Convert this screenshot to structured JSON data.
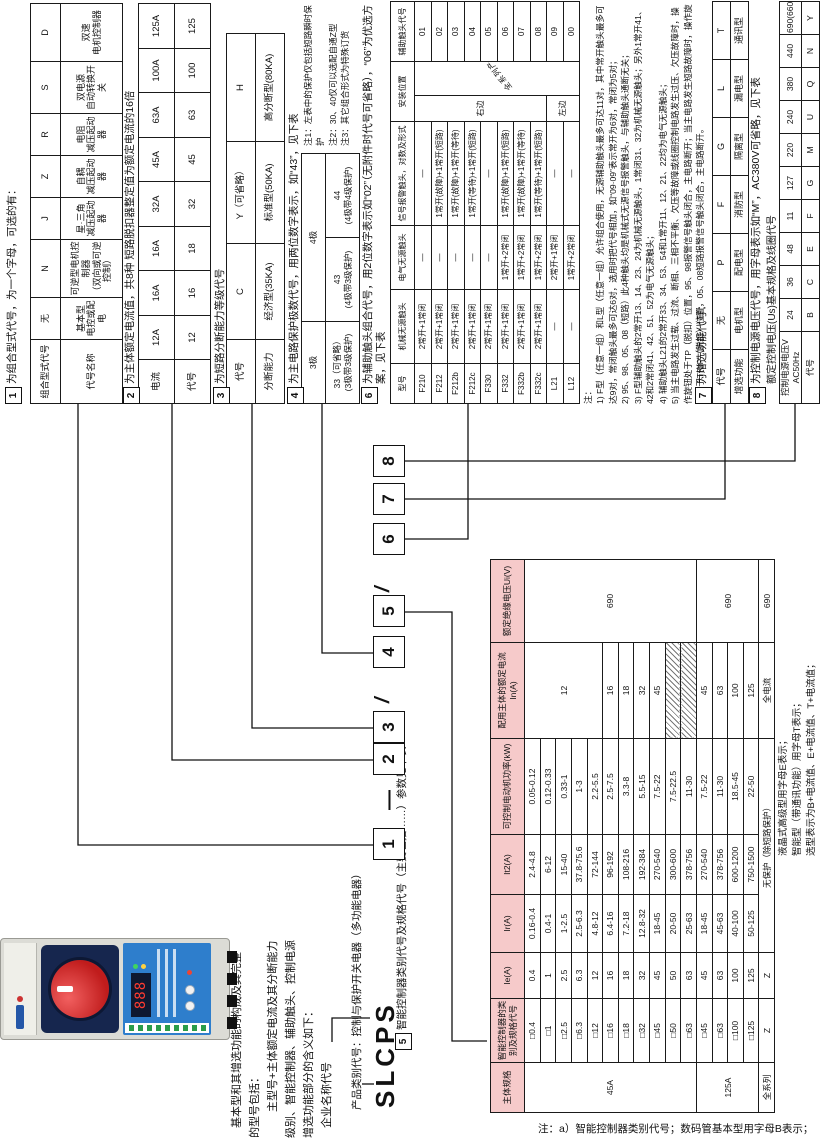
{
  "footer_note": "注：a）智能控制器类别代号；数码管基本型用字母B表示；",
  "brand": "SLCPS",
  "photo": {
    "display": "888"
  },
  "description": {
    "lines": [
      "基本型和其增选功能的构成及其完整",
      "的型号包括：",
      "主型号+主体额定电流及其分断能力",
      "级别、智能控制器、辅助触头、控制电源",
      "增选功能部分的含义如下：",
      "企业名称代号"
    ]
  },
  "model_line": {
    "digits": [
      "1",
      "2",
      "3",
      "4",
      "5",
      "6",
      "7",
      "8"
    ],
    "dash": "—",
    "slash": "/"
  },
  "titles": [
    {
      "n": "1",
      "t": "为组合型式代号，为一个字母，可选的有：",
      "x": 742,
      "y": 6,
      "w": 400
    },
    {
      "n": "2",
      "t": "为主体额定电流值，共8种 短路脱扣器整定值为额定电流的16倍",
      "x": 742,
      "y": 124,
      "w": 400
    },
    {
      "n": "3",
      "t": "为短路分断能力等级代号",
      "x": 742,
      "y": 214,
      "w": 400
    },
    {
      "n": "4",
      "t": "为主电路保护极数代号，用两位数字表示，如“43”，见下表",
      "x": 742,
      "y": 288,
      "w": 400
    },
    {
      "n": "6",
      "t": "为辅助触头组合代号，用2位数字表示如“02”（无附件时代号可省略），“06”为优选方案，见下表",
      "x": 742,
      "y": 362,
      "w": 382
    },
    {
      "n": "7",
      "t": "为增选功能代号：",
      "x": 742,
      "y": 696,
      "w": 380
    },
    {
      "n": "8",
      "t": "为控制电源电压代号，用字母表示如“M”，AC380V可省略，见下表",
      "x": 742,
      "y": 750,
      "w": 382
    },
    {
      "n": "5",
      "t": "智能控制器类别代号及规格代号（主要包括……）参数见下表",
      "x": 96,
      "y": 396,
      "w": 420
    }
  ],
  "texts": [
    {
      "name": "product-category-label",
      "t": "产品类别代号：控制与保护开关电器（多功能电器）",
      "x": 36,
      "y": 350,
      "w": 300,
      "s": 10.5,
      "nowrap": true
    },
    {
      "name": "voltage-subtitle",
      "t": "额定控制电压(Us)基本规格及线圈代号",
      "x": 762,
      "y": 766,
      "w": 360,
      "s": 10
    },
    {
      "name": "pole-table-notes",
      "t": "注1：左表中的保护仅包括短路瞬时保护\n注2：30、40仅可以选配自通Z型\n注3：其它组合形式为特殊订货",
      "x": 1000,
      "y": 302,
      "w": 146,
      "s": 8.5
    },
    {
      "name": "aux-contact-notes",
      "t": "注：\n1) F型（任意一组）和L型（任意一组）允许组合使用，无源辅助触头最多可达11对，其中常开触头最多可达9对，常闭触头最多可达6对，选用时把代号相加，如“09·09”表示常开为6对，常闭为5对；\n2) 95、98、05、08（短路）此4种触头均是机械式无源信号报警触头，与辅助触头通断无关；\n3) F型辅助触头的2常开13、14、23、24为机械无源触头，1常闭31、32为机械无源触头；另外1常开41、42和2常闭41、42、51、52为电气无源触头；\n4) 辅助触头L21的2常开33、34、53、54和1常开11、12、21、22均为电气无源触头；\n5) 当主电路发生过载、过流、断相、三相不平衡、欠压等故障或线圈控制电路发生过压、欠压故障时，操作旋钮处于TP（脱扣）位置，95、98报警信号触头闭合，主电路断开；当主电路发生短路故障时，操作旋钮处于TRIP（脱扣）位置，05、08短路报警信号触头闭合，主电路断开。",
      "x": 742,
      "y": 582,
      "w": 404,
      "s": 8.6
    },
    {
      "name": "controller-note-1",
      "t": "液晶式高级型用字母E表示；",
      "x": 290,
      "y": 777,
      "w": 320,
      "s": 9.5,
      "nowrap": true
    },
    {
      "name": "controller-note-2",
      "t": "智能型（带通讯功能）用字母T表示；",
      "x": 290,
      "y": 791,
      "w": 320,
      "s": 9.5,
      "nowrap": true
    },
    {
      "name": "controller-note-3",
      "t": "选型表示为B+电流值、E+电流值、T+电流值；",
      "x": 290,
      "y": 805,
      "w": 330,
      "s": 9.5,
      "nowrap": true
    }
  ],
  "tables": [
    {
      "name": "table-combination-type",
      "x": 742,
      "y": 30,
      "w": 400,
      "h": 92,
      "fs": 9,
      "cols": [
        64,
        42,
        58,
        42,
        42,
        42,
        52,
        58
      ],
      "rh": [
        30,
        62
      ],
      "rows": [
        [
          "组合型式代号",
          "无",
          "N",
          "J",
          "Z",
          "R",
          "S",
          "D"
        ],
        [
          "代号名称",
          "基本型\n电控或配电",
          "可逆型电机控制器\n（双向或可逆控制）",
          "星·三角\n减压起动器",
          "自耦\n减压起动器",
          "电阻\n减压起动器",
          "双电源\n自动转换开关",
          "双速\n电机控制器"
        ]
      ]
    },
    {
      "name": "table-rated-current",
      "x": 742,
      "y": 138,
      "w": 400,
      "h": 72,
      "fs": 9.5,
      "cols": [
        44,
        44,
        45,
        44,
        45,
        44,
        45,
        44,
        45
      ],
      "rh": [
        36,
        36
      ],
      "rows": [
        [
          "电流",
          "12A",
          "16A",
          "16A",
          "32A",
          "45A",
          "63A",
          "100A",
          "125A"
        ],
        [
          "代号",
          "12",
          "16",
          "18",
          "32",
          "45",
          "63",
          "100",
          "125"
        ]
      ]
    },
    {
      "name": "table-breaking-capacity",
      "x": 742,
      "y": 226,
      "w": 370,
      "h": 58,
      "fs": 9.5,
      "cols": [
        64,
        96,
        102,
        108
      ],
      "rh": [
        29,
        29
      ],
      "rows": [
        [
          "代号",
          "C",
          "Y（可省略）",
          "H"
        ],
        [
          "分断能力",
          "经济型(35KA)",
          "标准型(50KA)",
          "高分断型(80KA)"
        ]
      ]
    },
    {
      "name": "table-pole-count",
      "x": 742,
      "y": 301,
      "w": 250,
      "h": 58,
      "fs": 8.5,
      "cols": [
        82,
        84,
        84
      ],
      "rh": [
        24,
        34
      ],
      "rows": [
        [
          "3极",
          {
            "t": "4极",
            "cs": 2
          }
        ],
        [
          "33（可省略）\n(3极带3级保护)",
          "43\n(4极带3级保护)",
          "44\n(4极带4级保护)"
        ]
      ]
    },
    {
      "name": "table-aux-contacts",
      "x": 742,
      "y": 390,
      "w": 402,
      "h": 190,
      "fs": 8,
      "cols": [
        40,
        74,
        64,
        104,
        26,
        34,
        60
      ],
      "rh": [
        24
      ],
      "rows": [
        [
          "型号",
          "机械无源触头",
          "电气无源触头",
          "信号报警触头，对数及形式",
          {
            "t": "安装位置",
            "cs": 2
          },
          "辅助触头代号"
        ],
        [
          "F210",
          "2常开+1常闭",
          "—",
          "—",
          {
            "t": "右边",
            "rs": 8
          },
          {
            "t": "全系列产品",
            "rs": 10,
            "cls": "diag"
          },
          "01"
        ],
        [
          "F212",
          "2常开+1常闭",
          "—",
          "1常开(故障)+1常开(短路)",
          "02"
        ],
        [
          "F212b",
          "2常开+1常闭",
          "—",
          "1常开(故障)+1常开(等待)",
          "03"
        ],
        [
          "F212c",
          "2常开+1常闭",
          "—",
          "1常开(等待)+1常开(短路)",
          "04"
        ],
        [
          "F330",
          "2常开+1常闭",
          "—",
          "—",
          "05"
        ],
        [
          "F332",
          "2常开+1常闭",
          "1常开+2常闭",
          "1常开(故障)+1常开(短路)",
          "06"
        ],
        [
          "F332b",
          "2常开+1常闭",
          "1常开+2常闭",
          "1常开(故障)+1常开(等待)",
          "07"
        ],
        [
          "F332c",
          "2常开+1常闭",
          "1常开+2常闭",
          "1常开(等待)+1常开(短路)",
          "08"
        ],
        [
          "L21",
          "—",
          "2常开+1常闭",
          "—",
          {
            "t": "左边",
            "rs": 2
          },
          "09"
        ],
        [
          "L12",
          "—",
          "1常开+2常闭",
          "—",
          "00"
        ]
      ]
    },
    {
      "name": "table-optional-functions",
      "x": 742,
      "y": 712,
      "w": 402,
      "h": 36,
      "fs": 9,
      "cols": [
        54,
        58,
        58,
        58,
        58,
        58,
        58
      ],
      "rh": [
        18,
        18
      ],
      "rows": [
        [
          "代号",
          "无",
          "P",
          "F",
          "G",
          "L",
          "T"
        ],
        [
          "增选功能",
          "电机型",
          "配电型",
          "消防型",
          "隔离型",
          "漏电型",
          "通讯型"
        ]
      ]
    },
    {
      "name": "table-control-voltage",
      "x": 742,
      "y": 779,
      "w": 402,
      "h": 40,
      "fs": 8.5,
      "cols": [
        72,
        33,
        33,
        33,
        33,
        33,
        33,
        33,
        33,
        33,
        33
      ],
      "rh": [
        22,
        18
      ],
      "rows": [
        [
          {
            "t": "控制电源电压V\nAC50Hz",
            "cls": "grp"
          },
          "24",
          "36",
          "48",
          "11",
          "127",
          "220",
          "240",
          "380",
          "440",
          "690(660)"
        ],
        [
          "代号",
          "B",
          "C",
          "E",
          "F",
          "G",
          "M",
          "U",
          "Q",
          "N",
          "Y"
        ]
      ]
    },
    {
      "name": "table-controller-specs",
      "x": 33,
      "y": 490,
      "w": 553,
      "h": 285,
      "fs": 8.5,
      "cols": [
        50,
        64,
        46,
        58,
        60,
        96,
        96,
        83
      ],
      "rh": [
        34
      ],
      "rows": [
        [
          {
            "t": "主体规格",
            "cls": "pinkhdr"
          },
          {
            "t": "智能控制器的类别及规格代号",
            "cls": "pinkhdr"
          },
          {
            "t": "Ie(A)",
            "cls": "pinkhdr"
          },
          {
            "t": "Ir(A)",
            "cls": "pinkhdr"
          },
          {
            "t": "It2(A)",
            "cls": "pinkhdr"
          },
          {
            "t": "可控制电动机功率(kW)",
            "cls": "pinkhdr"
          },
          {
            "t": "配用主体的额定电流In(A)",
            "cls": "pinkhdr"
          },
          {
            "t": "额定绝缘电压Ui(V)",
            "cls": "pinkhdr"
          }
        ],
        [
          {
            "t": "45A",
            "rs": 11,
            "cls": "grp"
          },
          "□0.4",
          "0.4",
          "0.16-0.4",
          "2.4-4.8",
          "0.05-0.12",
          {
            "t": "12",
            "rs": 5
          },
          {
            "t": "690",
            "rs": 11
          }
        ],
        [
          "□1",
          "1",
          "0.4-1",
          "6-12",
          "0.12-0.33"
        ],
        [
          "□2.5",
          "2.5",
          "1-2.5",
          "15-40",
          "0.33-1"
        ],
        [
          "□6.3",
          "6.3",
          "2.5-6.3",
          "37.8-75.6",
          "1-3"
        ],
        [
          "□12",
          "12",
          "4.8-12",
          "72-144",
          "2.2-5.5"
        ],
        [
          "□16",
          "16",
          "6.4-16",
          "96-192",
          "2.5-7.5",
          "16"
        ],
        [
          "□18",
          "18",
          "7.2-18",
          "108-216",
          "3.3-8",
          "18"
        ],
        [
          "□32",
          "32",
          "12.8-32",
          "192-384",
          "5.5-15",
          "32"
        ],
        [
          "□45",
          "45",
          "18-45",
          "270-540",
          "7.5-22",
          "45"
        ],
        [
          "□50",
          "50",
          "20-50",
          "300-600",
          "7.5-22.5",
          {
            "t": "",
            "cls": "hatch"
          }
        ],
        [
          "□63",
          "63",
          "25-63",
          "378-756",
          "11-30",
          {
            "t": "",
            "cls": "hatch"
          }
        ],
        [
          {
            "t": "125A",
            "rs": 4,
            "cls": "grp"
          },
          "□45",
          "45",
          "18-45",
          "270-540",
          "7.5-22",
          "45",
          {
            "t": "690",
            "rs": 4
          }
        ],
        [
          "□63",
          "63",
          "45-63",
          "378-756",
          "11-30",
          "63"
        ],
        [
          "□100",
          "100",
          "40-100",
          "600-1200",
          "18.5-45",
          "100"
        ],
        [
          "□125",
          "125",
          "50-125",
          "750-1500",
          "22-50",
          "125"
        ],
        [
          {
            "t": "全系列",
            "cls": "grp"
          },
          "Z",
          "Z",
          {
            "t": "无保护（除短路保护）",
            "cs": 3
          },
          "全电流",
          "690"
        ]
      ]
    }
  ],
  "callouts": [
    [
      [
        301,
        373
      ],
      [
        301,
        78
      ],
      [
        742,
        78
      ]
    ],
    [
      [
        386,
        373
      ],
      [
        386,
        172
      ],
      [
        742,
        172
      ]
    ],
    [
      [
        418,
        373
      ],
      [
        418,
        252
      ],
      [
        742,
        252
      ]
    ],
    [
      [
        493,
        373
      ],
      [
        493,
        322
      ],
      [
        742,
        322
      ]
    ],
    [
      [
        534,
        403
      ],
      [
        534,
        452
      ],
      [
        105,
        452
      ],
      [
        105,
        487
      ]
    ],
    [
      [
        607,
        403
      ],
      [
        607,
        468
      ],
      [
        742,
        468
      ]
    ],
    [
      [
        647,
        403
      ],
      [
        647,
        725
      ],
      [
        742,
        725
      ]
    ],
    [
      [
        685,
        403
      ],
      [
        685,
        795
      ],
      [
        742,
        795
      ]
    ],
    [
      [
        104,
        332
      ],
      [
        128,
        332
      ],
      [
        128,
        370
      ]
    ],
    [
      [
        62,
        362
      ],
      [
        62,
        374
      ]
    ]
  ]
}
